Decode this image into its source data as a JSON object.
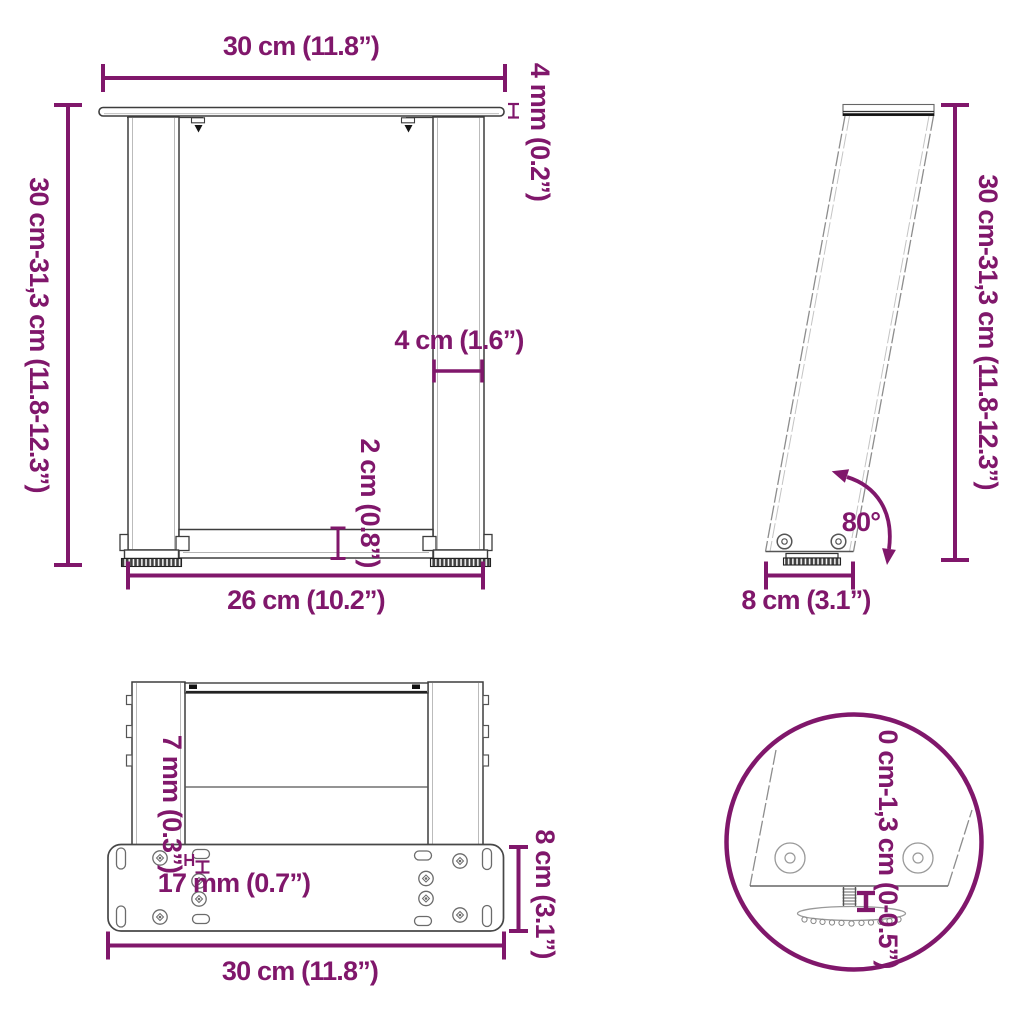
{
  "colors": {
    "accent": "#80176B",
    "line": "#3D3D3D"
  },
  "front": {
    "top_width": "30 cm (11.8”)",
    "plate_thickness": "4 mm (0.2”)",
    "height": "30 cm-31,3 cm (11.8-12.3”)",
    "leg_width": "4 cm (1.6”)",
    "crossbar_height": "2 cm (0.8”)",
    "bottom_width": "26 cm (10.2”)"
  },
  "side": {
    "height": "30 cm-31,3 cm (11.8-12.3”)",
    "angle": "80°",
    "foot_depth": "8 cm (3.1”)"
  },
  "bottom": {
    "slot_width": "7 mm (0.3”)",
    "hole_spacing": "17 mm (0.7”)",
    "plate_depth": "8 cm (3.1”)",
    "plate_width": "30 cm (11.8”)"
  },
  "detail": {
    "adjustable_range": "0 cm-1,3 cm (0-0.5”)"
  }
}
